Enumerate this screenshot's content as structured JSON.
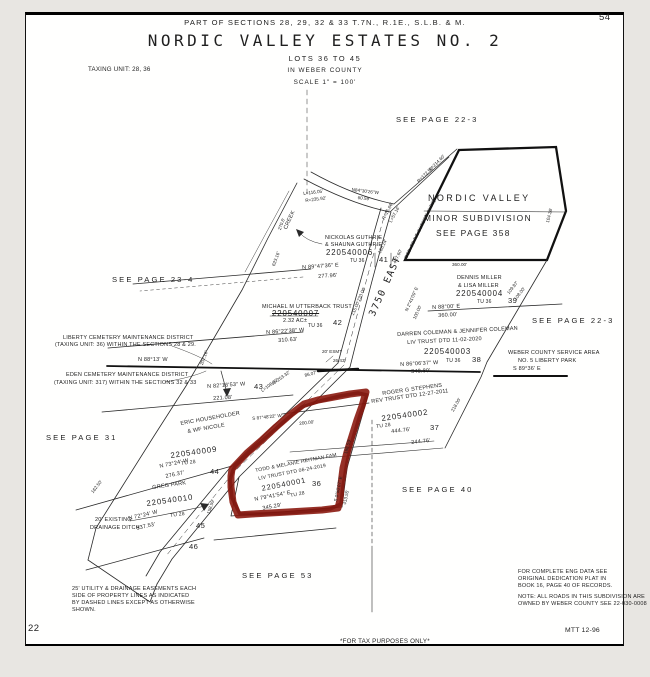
{
  "page": {
    "number_right": "54",
    "number_left": "22",
    "footer": "*FOR TAX PURPOSES ONLY*",
    "ref": "MTT 12-96"
  },
  "header": {
    "sections": "PART OF SECTIONS 28, 29, 32 & 33 T.7N., R.1E., S.L.B. & M.",
    "title": "NORDIC VALLEY ESTATES NO. 2",
    "lots_range": "LOTS 36 TO 45",
    "county": "IN WEBER COUNTY",
    "scale": "SCALE 1\" = 100'",
    "taxing_unit": "TAXING UNIT: 28, 36"
  },
  "see_pages": {
    "top": "SEE PAGE 22-3",
    "left": "SEE PAGE 23-4",
    "right": "SEE PAGE 22-3",
    "p31": "SEE PAGE 31",
    "p40": "SEE PAGE 40",
    "p53": "SEE PAGE 53"
  },
  "minor_subdivision": {
    "line1": "NORDIC VALLEY",
    "line2": "MINOR SUBDIVISION",
    "line3": "SEE PAGE 358",
    "dim": "360.00'"
  },
  "parcels": {
    "guthrie": {
      "n1": "NICKOLAS GUTHRIE",
      "n2": "& SHAUNA GUTHRIE",
      "num": "220540006",
      "tu": "TU 36",
      "lot": "41",
      "brg": "N 89°47'36\" E",
      "dst": "277.96'"
    },
    "utterback": {
      "n1": "MICHAEL M UTTERBACK TRUST",
      "num": "220540007",
      "ac": "2.32 AC±",
      "tu": "TU 36",
      "lot": "42",
      "brg": "N 86°22'38\" W",
      "dst": "310.63'"
    },
    "miller": {
      "n1": "DENNIS MILLER",
      "n2": "& LISA MILLER",
      "num": "220540004",
      "tu": "TU 36",
      "lot": "39",
      "brg": "N 88°00' E",
      "dst": "360.00'"
    },
    "coleman": {
      "n1": "DARREN COLEMAN & JENNIFER COLEMAN",
      "n2": "LIV TRUST DTD 11-02-2020",
      "num": "220540003",
      "tu": "TU 36",
      "lot": "38",
      "brg": "N 86°06'37\" W",
      "dst": "348.80'"
    },
    "stephens": {
      "n1": "ROGER G STEPHENS",
      "n2": "REV TRUST DTD 12-27-2011",
      "num": "220540002",
      "tu": "TU 28",
      "lot": "37",
      "d1": "444.76'",
      "d2": "244.76'"
    },
    "householder": {
      "n1": "ERIC HOUSEHOLDER",
      "n2": "& WF NICOLE",
      "num": "220540009",
      "tu": "TU 28",
      "lot": "44",
      "brg": "N 73°24' W",
      "dst": "276.37'"
    },
    "heitman": {
      "n1": "TODD & MELANIE HEITMAN FAM",
      "n2": "LIV TRUST DTD 06-24-2019",
      "num": "220540001",
      "tu": "TU 28",
      "lot": "36",
      "brg": "N 79°41'54\" E",
      "dst": "345.29'"
    },
    "park": {
      "n1": "GREG PARK",
      "num": "220540010",
      "tu": "TU 28",
      "lot": "45",
      "brg": "N 72°24' W",
      "dst": "337.53'"
    }
  },
  "lots": {
    "lot43_brg": "N 82°16'53\" W",
    "lot43": "43",
    "lot43_dst": "221.08'",
    "lot46": "46"
  },
  "service_area": {
    "n1": "WEBER COUNTY SERVICE AREA",
    "n2": "NO. 5 LIBERTY PARK",
    "brg": "S 89°36' E"
  },
  "districts": {
    "lib1": "LIBERTY CEMETERY MAINTENANCE DISTRICT",
    "lib2": "(TAXING UNIT: 36) WITHIN THE SECTIONS 28 & 29.",
    "brg": "N 88°13' W",
    "eden1": "EDEN CEMETERY MAINTENANCE DISTRICT",
    "eden2": "(TAXING UNIT: 317) WITHIN THE SECTIONS 32 & 33"
  },
  "notes": {
    "e1": "25' UTILITY & DRAINAGE EASEMENTS EACH",
    "e2": "SIDE OF PROPERTY LINES AS INDICATED",
    "e3": "BY DASHED LINES EXCEPT AS OTHERWISE",
    "e4": "SHOWN.",
    "eng1": "FOR COMPLETE ENG DATA SEE",
    "eng2": "ORIGINAL DEDICATION PLAT IN",
    "eng3": "BOOK 16, PAGE 40 OF RECORDS.",
    "rd1": "NOTE:  ALL ROADS IN THIS SUBDIVISION ARE",
    "rd2": "OWNED BY WEBER COUNTY SEE 22-030-0008"
  },
  "road": {
    "name": "3750 EAST",
    "ded": "(DED. TO P.T. OUTSIDE SUBD)",
    "dim": "487.60'"
  },
  "misc": {
    "creek": "CREEK",
    "esmt": "20' ESMT",
    "ditch1": "20' EXISTING",
    "ditch2": "DRAINAGE DITCH"
  },
  "dims": {
    "l116": "L=116.05'",
    "r235": "R=235.92'",
    "n84": "N84°30'26\"W",
    "d6059": "60.59'",
    "r172": "R=172.98'",
    "l214": "L=214.60'",
    "r26": "R=26.66'",
    "l57": "L=57.16'",
    "d18824": "188.24'",
    "d10436": "104.36'",
    "n241": "N 2°41'09\" E",
    "d100": "100.00'",
    "d233": "233.00'",
    "d215": "215.00'",
    "d202": "202.16'",
    "d2706": "270.6'",
    "d62316": "623.16'",
    "l108": "L=108.02'",
    "r253": "R=253.32'",
    "d8607": "86.07'",
    "d2643": "26.43'",
    "d200": "200.00'",
    "s8748": "S 87°48'22\" W",
    "d218": "218.00'",
    "d10987": "109.87'",
    "d10800": "108.00'",
    "d18859": "188.59'",
    "s050": "S 0°50'07\" E",
    "d41355": "413.55'",
    "d16250": "162.50'",
    "d15859": "158.59'"
  },
  "colors": {
    "highlight": "#8b1a10",
    "paper": "#fffffe",
    "line": "#222222"
  }
}
